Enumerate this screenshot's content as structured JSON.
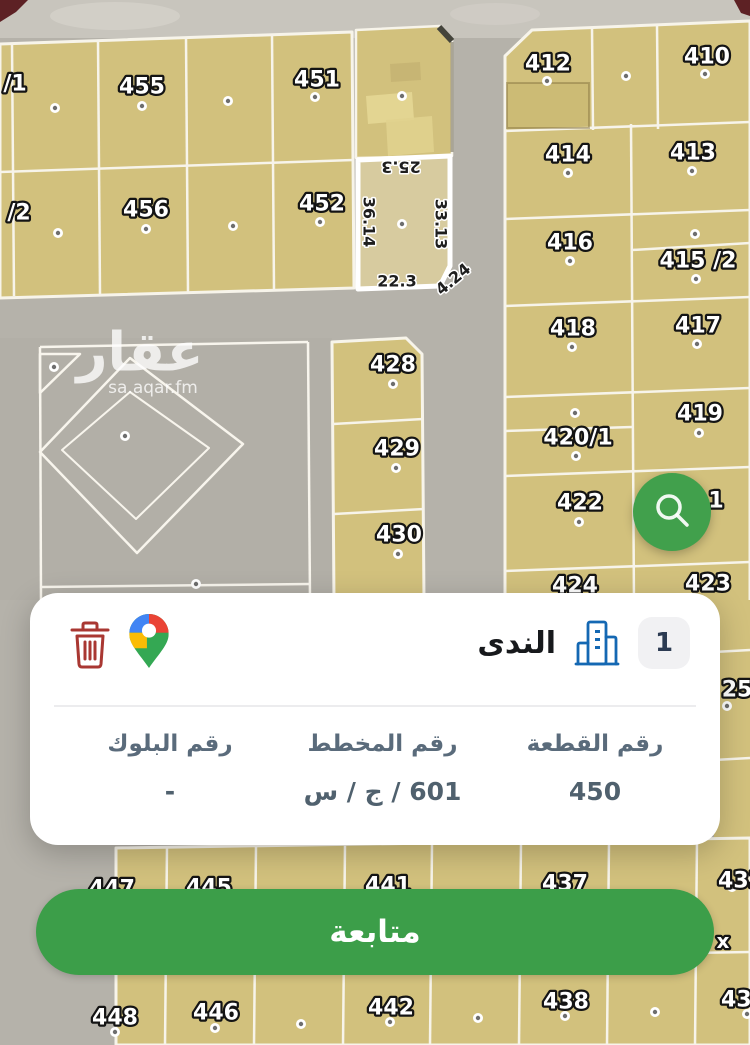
{
  "card": {
    "district_name": "الندى",
    "badge": "1",
    "fields": [
      {
        "label": "رقم القطعة",
        "value": "450"
      },
      {
        "label": "رقم المخطط",
        "value": "601 / ج / س"
      },
      {
        "label": "رقم البلوك",
        "value": "-"
      }
    ]
  },
  "cta": {
    "label": "متابعة"
  },
  "colors": {
    "parcel": "#d2c17d",
    "parcel_selected": "#d7cb9f",
    "street": "#b5b2aa",
    "line": "#f7f4ea",
    "green_fab": "#41a04c",
    "green_cta": "#3c9e49",
    "trash_red": "#a93732",
    "building_blue": "#1468b3",
    "label_slate": "#5a6b7b"
  },
  "map": {
    "watermark": {
      "title": "عقار",
      "x": 140,
      "y": 352,
      "subtitle": "sa.aqar.fm",
      "sx": 153,
      "sy": 388
    },
    "shapes": [
      {
        "t": "rect",
        "x": 0,
        "y": 0,
        "w": 750,
        "h": 1045,
        "f": "#b5b2aa"
      },
      {
        "t": "rect",
        "x": 0,
        "y": 0,
        "w": 750,
        "h": 38,
        "f": "#c8c5bd"
      },
      {
        "t": "ellipse",
        "cx": 115,
        "cy": 16,
        "rx": 65,
        "ry": 14,
        "f": "#dad7cf",
        "o": 0.55
      },
      {
        "t": "ellipse",
        "cx": 495,
        "cy": 14,
        "rx": 45,
        "ry": 11,
        "f": "#d6d3cb",
        "o": 0.45
      },
      {
        "t": "poly",
        "pts": [
          [
            0,
            0
          ],
          [
            28,
            0
          ],
          [
            16,
            12
          ],
          [
            0,
            22
          ]
        ],
        "f": "#5d2124"
      },
      {
        "t": "poly",
        "pts": [
          [
            734,
            0
          ],
          [
            750,
            0
          ],
          [
            750,
            16
          ],
          [
            741,
            13
          ]
        ],
        "f": "#5d2124"
      },
      {
        "t": "rect",
        "x": 0,
        "y": 338,
        "w": 332,
        "h": 262,
        "f": "#b2afa7"
      },
      {
        "t": "poly",
        "pts": [
          [
            0,
            44
          ],
          [
            352,
            32
          ],
          [
            354,
            288
          ],
          [
            0,
            298
          ]
        ],
        "f": "#d2c17d",
        "s": "#f7f4ea",
        "sw": 3
      },
      {
        "t": "line",
        "x1": 12,
        "y1": 44,
        "x2": 14,
        "y2": 296
      },
      {
        "t": "line",
        "x1": 98,
        "y1": 41,
        "x2": 100,
        "y2": 294
      },
      {
        "t": "line",
        "x1": 186,
        "y1": 38,
        "x2": 188,
        "y2": 292
      },
      {
        "t": "line",
        "x1": 272,
        "y1": 35,
        "x2": 274,
        "y2": 290
      },
      {
        "t": "line",
        "x1": 0,
        "y1": 172,
        "x2": 353,
        "y2": 160
      },
      {
        "t": "poly",
        "pts": [
          [
            356,
            158
          ],
          [
            356,
            30
          ],
          [
            440,
            26
          ],
          [
            452,
            40
          ],
          [
            452,
            156
          ]
        ],
        "f": "#d2c17d",
        "s": "#f7f4ea",
        "sw": 2.5
      },
      {
        "t": "line",
        "x1": 439,
        "y1": 27,
        "x2": 452,
        "y2": 41,
        "s": "#44443b",
        "sw": 6
      },
      {
        "t": "line",
        "x1": 452,
        "y1": 42,
        "x2": 452,
        "y2": 152,
        "s": "#8a8572",
        "sw": 3,
        "o": 0.7
      },
      {
        "t": "poly",
        "pts": [
          [
            366,
            96
          ],
          [
            412,
            92
          ],
          [
            414,
            120
          ],
          [
            368,
            124
          ]
        ],
        "f": "#e4d694",
        "o": 0.95
      },
      {
        "t": "poly",
        "pts": [
          [
            386,
            120
          ],
          [
            432,
            116
          ],
          [
            434,
            152
          ],
          [
            388,
            156
          ]
        ],
        "f": "#e0d18e",
        "o": 0.9
      },
      {
        "t": "poly",
        "pts": [
          [
            390,
            64
          ],
          [
            420,
            62
          ],
          [
            421,
            80
          ],
          [
            391,
            82
          ]
        ],
        "f": "#c4b272",
        "o": 0.8
      },
      {
        "t": "poly",
        "pts": [
          [
            532,
            30
          ],
          [
            750,
            21
          ],
          [
            750,
            608
          ],
          [
            505,
            608
          ],
          [
            505,
            56
          ]
        ],
        "f": "#d2c17d",
        "s": "#f7f4ea",
        "sw": 3
      },
      {
        "t": "rect",
        "x": 714,
        "y": 600,
        "w": 36,
        "h": 252,
        "f": "#d2c17d"
      },
      {
        "t": "line",
        "x1": 714,
        "y1": 652,
        "x2": 750,
        "y2": 650
      },
      {
        "t": "line",
        "x1": 714,
        "y1": 760,
        "x2": 750,
        "y2": 758
      },
      {
        "t": "line",
        "x1": 592,
        "y1": 28,
        "x2": 593,
        "y2": 130
      },
      {
        "t": "line",
        "x1": 657,
        "y1": 25,
        "x2": 658,
        "y2": 129
      },
      {
        "t": "line",
        "x1": 505,
        "y1": 131,
        "x2": 750,
        "y2": 122
      },
      {
        "t": "line",
        "x1": 631,
        "y1": 124,
        "x2": 634,
        "y2": 606
      },
      {
        "t": "line",
        "x1": 505,
        "y1": 219,
        "x2": 750,
        "y2": 210
      },
      {
        "t": "line",
        "x1": 632,
        "y1": 250,
        "x2": 750,
        "y2": 243
      },
      {
        "t": "line",
        "x1": 505,
        "y1": 306,
        "x2": 750,
        "y2": 297
      },
      {
        "t": "line",
        "x1": 505,
        "y1": 397,
        "x2": 750,
        "y2": 388
      },
      {
        "t": "line",
        "x1": 505,
        "y1": 431,
        "x2": 632,
        "y2": 427
      },
      {
        "t": "line",
        "x1": 505,
        "y1": 476,
        "x2": 750,
        "y2": 467
      },
      {
        "t": "line",
        "x1": 505,
        "y1": 571,
        "x2": 750,
        "y2": 562
      },
      {
        "t": "rect",
        "x": 507,
        "y": 83,
        "w": 82,
        "h": 45,
        "f": "rgba(196,178,104,0.35)",
        "s": "rgba(128,110,60,0.45)",
        "sw": 2
      },
      {
        "t": "poly",
        "pts": [
          [
            332,
            342
          ],
          [
            406,
            338
          ],
          [
            422,
            354
          ],
          [
            424,
            600
          ],
          [
            334,
            600
          ]
        ],
        "f": "#d2c17d",
        "s": "#f7f4ea",
        "sw": 3
      },
      {
        "t": "line",
        "x1": 333,
        "y1": 424,
        "x2": 423,
        "y2": 419
      },
      {
        "t": "line",
        "x1": 334,
        "y1": 514,
        "x2": 424,
        "y2": 509
      },
      {
        "t": "poly",
        "pts": [
          [
            116,
            848
          ],
          [
            750,
            838
          ],
          [
            750,
            1045
          ],
          [
            116,
            1045
          ]
        ],
        "f": "#d2c17d",
        "s": "#f7f4ea",
        "sw": 3
      },
      {
        "t": "line",
        "x1": 167,
        "y1": 847,
        "x2": 165,
        "y2": 1045
      },
      {
        "t": "line",
        "x1": 256,
        "y1": 846,
        "x2": 254,
        "y2": 1045
      },
      {
        "t": "line",
        "x1": 345,
        "y1": 845,
        "x2": 343,
        "y2": 1045
      },
      {
        "t": "line",
        "x1": 432,
        "y1": 844,
        "x2": 430,
        "y2": 1045
      },
      {
        "t": "line",
        "x1": 521,
        "y1": 842,
        "x2": 519,
        "y2": 1045
      },
      {
        "t": "line",
        "x1": 609,
        "y1": 841,
        "x2": 607,
        "y2": 1045
      },
      {
        "t": "line",
        "x1": 697,
        "y1": 840,
        "x2": 695,
        "y2": 1045
      },
      {
        "t": "line",
        "x1": 116,
        "y1": 962,
        "x2": 750,
        "y2": 952
      },
      {
        "t": "line",
        "x1": 40,
        "y1": 347,
        "x2": 308,
        "y2": 342,
        "s": "#f8f5ed",
        "sw": 2.5
      },
      {
        "t": "line",
        "x1": 308,
        "y1": 342,
        "x2": 310,
        "y2": 600,
        "s": "#f8f5ed",
        "sw": 2.5
      },
      {
        "t": "line",
        "x1": 40,
        "y1": 347,
        "x2": 41,
        "y2": 600,
        "s": "#f8f5ed",
        "sw": 2.5
      },
      {
        "t": "line",
        "x1": 42,
        "y1": 587,
        "x2": 310,
        "y2": 584,
        "s": "#f8f5ed",
        "sw": 2.5
      },
      {
        "t": "poly",
        "pts": [
          [
            40,
            354
          ],
          [
            80,
            354
          ],
          [
            40,
            393
          ]
        ],
        "f": "none",
        "s": "#f8f5ed",
        "sw": 2.5
      },
      {
        "t": "poly",
        "pts": [
          [
            130,
            358
          ],
          [
            243,
            444
          ],
          [
            137,
            553
          ],
          [
            40,
            452
          ]
        ],
        "f": "none",
        "s": "#f8f5ed",
        "sw": 2.5
      },
      {
        "t": "poly",
        "pts": [
          [
            130,
            392
          ],
          [
            209,
            448
          ],
          [
            136,
            519
          ],
          [
            62,
            450
          ]
        ],
        "f": "none",
        "s": "#f8f5ed",
        "sw": 2
      },
      {
        "t": "poly",
        "pts": [
          [
            358,
            160
          ],
          [
            450,
            156
          ],
          [
            450,
            266
          ],
          [
            440,
            286
          ],
          [
            358,
            289
          ]
        ],
        "f": "#d7cb9f",
        "s": "#ffffff",
        "sw": 5,
        "n": "selected-parcel",
        "i": true
      }
    ],
    "labels": [
      {
        "text": "/1",
        "x": 15,
        "y": 84
      },
      {
        "text": "455",
        "x": 142,
        "y": 87
      },
      {
        "text": "451",
        "x": 317,
        "y": 80
      },
      {
        "text": "/2",
        "x": 19,
        "y": 213
      },
      {
        "text": "456",
        "x": 146,
        "y": 210
      },
      {
        "text": "452",
        "x": 322,
        "y": 204
      },
      {
        "text": "412",
        "x": 548,
        "y": 64
      },
      {
        "text": "410",
        "x": 707,
        "y": 57
      },
      {
        "text": "414",
        "x": 568,
        "y": 155
      },
      {
        "text": "413",
        "x": 693,
        "y": 153
      },
      {
        "text": "416",
        "x": 570,
        "y": 243
      },
      {
        "text": "415 /2",
        "x": 698,
        "y": 261
      },
      {
        "text": "418",
        "x": 573,
        "y": 329
      },
      {
        "text": "417",
        "x": 698,
        "y": 326
      },
      {
        "text": "420/1",
        "x": 578,
        "y": 438
      },
      {
        "text": "419",
        "x": 700,
        "y": 414
      },
      {
        "text": "422",
        "x": 580,
        "y": 503
      },
      {
        "text": "1",
        "x": 716,
        "y": 501
      },
      {
        "text": "424",
        "x": 575,
        "y": 586
      },
      {
        "text": "423",
        "x": 708,
        "y": 584
      },
      {
        "text": "25",
        "x": 737,
        "y": 690
      },
      {
        "text": "428",
        "x": 393,
        "y": 365
      },
      {
        "text": "429",
        "x": 397,
        "y": 449
      },
      {
        "text": "430",
        "x": 399,
        "y": 535
      },
      {
        "text": "447",
        "x": 112,
        "y": 889
      },
      {
        "text": "445",
        "x": 209,
        "y": 888
      },
      {
        "text": "441",
        "x": 388,
        "y": 886
      },
      {
        "text": "437",
        "x": 565,
        "y": 884
      },
      {
        "text": "433",
        "x": 741,
        "y": 881
      },
      {
        "text": "448",
        "x": 115,
        "y": 1018
      },
      {
        "text": "446",
        "x": 216,
        "y": 1013
      },
      {
        "text": "442",
        "x": 391,
        "y": 1008
      },
      {
        "text": "438",
        "x": 566,
        "y": 1002
      },
      {
        "text": "434",
        "x": 744,
        "y": 1000
      },
      {
        "text": "x",
        "x": 723,
        "y": 941,
        "size": 20
      }
    ],
    "dims": [
      {
        "text": "25.3",
        "x": 401,
        "y": 167,
        "rot": 180
      },
      {
        "text": "36.14",
        "x": 369,
        "y": 222,
        "rot": 90
      },
      {
        "text": "33.13",
        "x": 441,
        "y": 224,
        "rot": 90
      },
      {
        "text": "22.3",
        "x": 397,
        "y": 281,
        "rot": 0
      },
      {
        "text": "4.24",
        "x": 453,
        "y": 279,
        "rot": -40
      }
    ],
    "dots": [
      [
        55,
        108
      ],
      [
        142,
        106
      ],
      [
        228,
        101
      ],
      [
        315,
        97
      ],
      [
        58,
        233
      ],
      [
        146,
        229
      ],
      [
        233,
        226
      ],
      [
        320,
        222
      ],
      [
        402,
        96
      ],
      [
        402,
        224
      ],
      [
        547,
        81
      ],
      [
        626,
        76
      ],
      [
        705,
        74
      ],
      [
        568,
        173
      ],
      [
        692,
        171
      ],
      [
        570,
        261
      ],
      [
        695,
        234
      ],
      [
        696,
        279
      ],
      [
        572,
        347
      ],
      [
        697,
        344
      ],
      [
        575,
        413
      ],
      [
        576,
        456
      ],
      [
        699,
        433
      ],
      [
        579,
        522
      ],
      [
        393,
        384
      ],
      [
        396,
        468
      ],
      [
        398,
        554
      ],
      [
        54,
        367
      ],
      [
        125,
        436
      ],
      [
        196,
        584
      ],
      [
        727,
        706
      ],
      [
        732,
        887
      ],
      [
        115,
        1032
      ],
      [
        215,
        1028
      ],
      [
        301,
        1024
      ],
      [
        390,
        1022
      ],
      [
        478,
        1018
      ],
      [
        565,
        1016
      ],
      [
        655,
        1012
      ],
      [
        747,
        1014
      ]
    ]
  }
}
